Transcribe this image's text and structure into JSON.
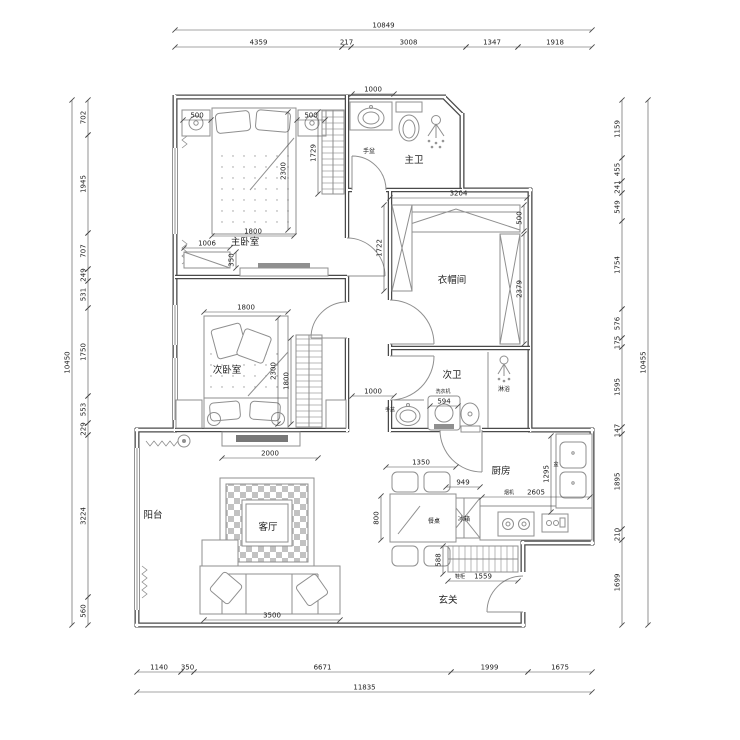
{
  "drawing": {
    "background": "#ffffff",
    "wall_color": "#4a4a4a",
    "furniture_color": "#8f8f8f",
    "dim_color": "#4a4a4a",
    "text_color": "#222222",
    "font_size_dim": 7,
    "font_size_room": 9.5,
    "font_size_small": 5.5
  },
  "room_labels": [
    {
      "id": "master-bedroom",
      "label": "主卧室",
      "x": 245,
      "y": 245
    },
    {
      "id": "master-bath",
      "label": "主卫",
      "x": 414,
      "y": 163
    },
    {
      "id": "cloakroom",
      "label": "衣帽间",
      "x": 452,
      "y": 283
    },
    {
      "id": "second-bedroom",
      "label": "次卧室",
      "x": 227,
      "y": 373
    },
    {
      "id": "second-bath",
      "label": "次卫",
      "x": 452,
      "y": 378
    },
    {
      "id": "kitchen",
      "label": "厨房",
      "x": 501,
      "y": 474
    },
    {
      "id": "living-room",
      "label": "客厅",
      "x": 268,
      "y": 530
    },
    {
      "id": "balcony",
      "label": "阳台",
      "x": 153,
      "y": 518
    },
    {
      "id": "entry",
      "label": "玄关",
      "x": 448,
      "y": 603
    }
  ],
  "fixture_labels": [
    {
      "id": "master-basin",
      "label": "手盆",
      "x": 369,
      "y": 153,
      "size": 6
    },
    {
      "id": "second-basin",
      "label": "手盆",
      "x": 390,
      "y": 411,
      "size": 5
    },
    {
      "id": "washing-machine",
      "label": "洗衣机",
      "x": 443,
      "y": 393,
      "size": 5
    },
    {
      "id": "shower",
      "label": "淋浴",
      "x": 504,
      "y": 391,
      "size": 6
    },
    {
      "id": "fridge",
      "label": "冰箱",
      "x": 464,
      "y": 521,
      "size": 6
    },
    {
      "id": "dining-table",
      "label": "餐桌",
      "x": 434,
      "y": 523,
      "size": 6
    },
    {
      "id": "range-hood",
      "label": "烟机",
      "x": 509,
      "y": 494,
      "size": 5
    },
    {
      "id": "shoe-cabinet",
      "label": "鞋柜",
      "x": 460,
      "y": 578,
      "size": 5
    },
    {
      "id": "kitchen-sink",
      "label": "盆",
      "x": 556,
      "y": 466,
      "size": 5
    }
  ],
  "dimensions": [
    [
      175,
      30,
      592,
      30,
      "10849"
    ],
    [
      175,
      47,
      342,
      47,
      "4359"
    ],
    [
      342,
      47,
      351,
      47,
      "217"
    ],
    [
      351,
      47,
      466,
      47,
      "3008"
    ],
    [
      466,
      47,
      518,
      47,
      "1347"
    ],
    [
      518,
      47,
      592,
      47,
      "1918"
    ],
    [
      72,
      100,
      72,
      625,
      "10450"
    ],
    [
      88,
      100,
      88,
      135,
      "702"
    ],
    [
      88,
      135,
      88,
      233,
      "1945"
    ],
    [
      88,
      233,
      88,
      269,
      "707"
    ],
    [
      88,
      269,
      88,
      281,
      "249"
    ],
    [
      88,
      281,
      88,
      308,
      "531"
    ],
    [
      88,
      308,
      88,
      396,
      "1750"
    ],
    [
      88,
      396,
      88,
      423,
      "553"
    ],
    [
      88,
      423,
      88,
      435,
      "229"
    ],
    [
      88,
      435,
      88,
      597,
      "3224"
    ],
    [
      88,
      597,
      88,
      625,
      "560"
    ],
    [
      622,
      100,
      622,
      158,
      "1159"
    ],
    [
      622,
      158,
      622,
      181,
      "455"
    ],
    [
      622,
      181,
      622,
      193,
      "241"
    ],
    [
      622,
      193,
      622,
      221,
      "549"
    ],
    [
      622,
      221,
      622,
      309,
      "1754"
    ],
    [
      622,
      309,
      622,
      338,
      "576"
    ],
    [
      622,
      338,
      622,
      347,
      "175"
    ],
    [
      622,
      347,
      622,
      427,
      "1595"
    ],
    [
      622,
      427,
      622,
      434,
      "147"
    ],
    [
      622,
      434,
      622,
      529,
      "1895"
    ],
    [
      622,
      529,
      622,
      540,
      "210"
    ],
    [
      622,
      540,
      622,
      625,
      "1699"
    ],
    [
      648,
      100,
      648,
      625,
      "10455"
    ],
    [
      137,
      672,
      181,
      672,
      "1140"
    ],
    [
      181,
      672,
      194,
      672,
      "350"
    ],
    [
      194,
      672,
      451,
      672,
      "6671"
    ],
    [
      451,
      672,
      528,
      672,
      "1999"
    ],
    [
      528,
      672,
      592,
      672,
      "1675"
    ],
    [
      137,
      692,
      592,
      692,
      "11835"
    ],
    [
      183,
      120,
      211,
      120,
      "500"
    ],
    [
      297,
      120,
      325,
      120,
      "500"
    ],
    [
      288,
      112,
      288,
      230,
      "2300"
    ],
    [
      212,
      236,
      294,
      236,
      "1800"
    ],
    [
      318,
      112,
      318,
      194,
      "1729"
    ],
    [
      184,
      248,
      230,
      248,
      "1006"
    ],
    [
      236,
      252,
      236,
      268,
      "350"
    ],
    [
      352,
      94,
      394,
      94,
      "1000"
    ],
    [
      390,
      198,
      527,
      198,
      "3204"
    ],
    [
      524,
      205,
      524,
      231,
      "500"
    ],
    [
      524,
      234,
      524,
      344,
      "2379"
    ],
    [
      384,
      205,
      384,
      291,
      "1722"
    ],
    [
      204,
      312,
      288,
      312,
      "1800"
    ],
    [
      278,
      318,
      278,
      424,
      "2300"
    ],
    [
      291,
      338,
      291,
      424,
      "1800"
    ],
    [
      352,
      396,
      394,
      396,
      "1000"
    ],
    [
      430,
      406,
      458,
      406,
      "594"
    ],
    [
      446,
      487,
      480,
      487,
      "949"
    ],
    [
      482,
      497,
      590,
      497,
      "2605"
    ],
    [
      551,
      436,
      551,
      512,
      "1295"
    ],
    [
      386,
      467,
      456,
      467,
      "1350"
    ],
    [
      381,
      496,
      381,
      540,
      "800"
    ],
    [
      443,
      546,
      443,
      574,
      "588"
    ],
    [
      448,
      581,
      518,
      581,
      "1559"
    ],
    [
      222,
      458,
      318,
      458,
      "2000"
    ],
    [
      204,
      620,
      340,
      620,
      "3500"
    ]
  ]
}
